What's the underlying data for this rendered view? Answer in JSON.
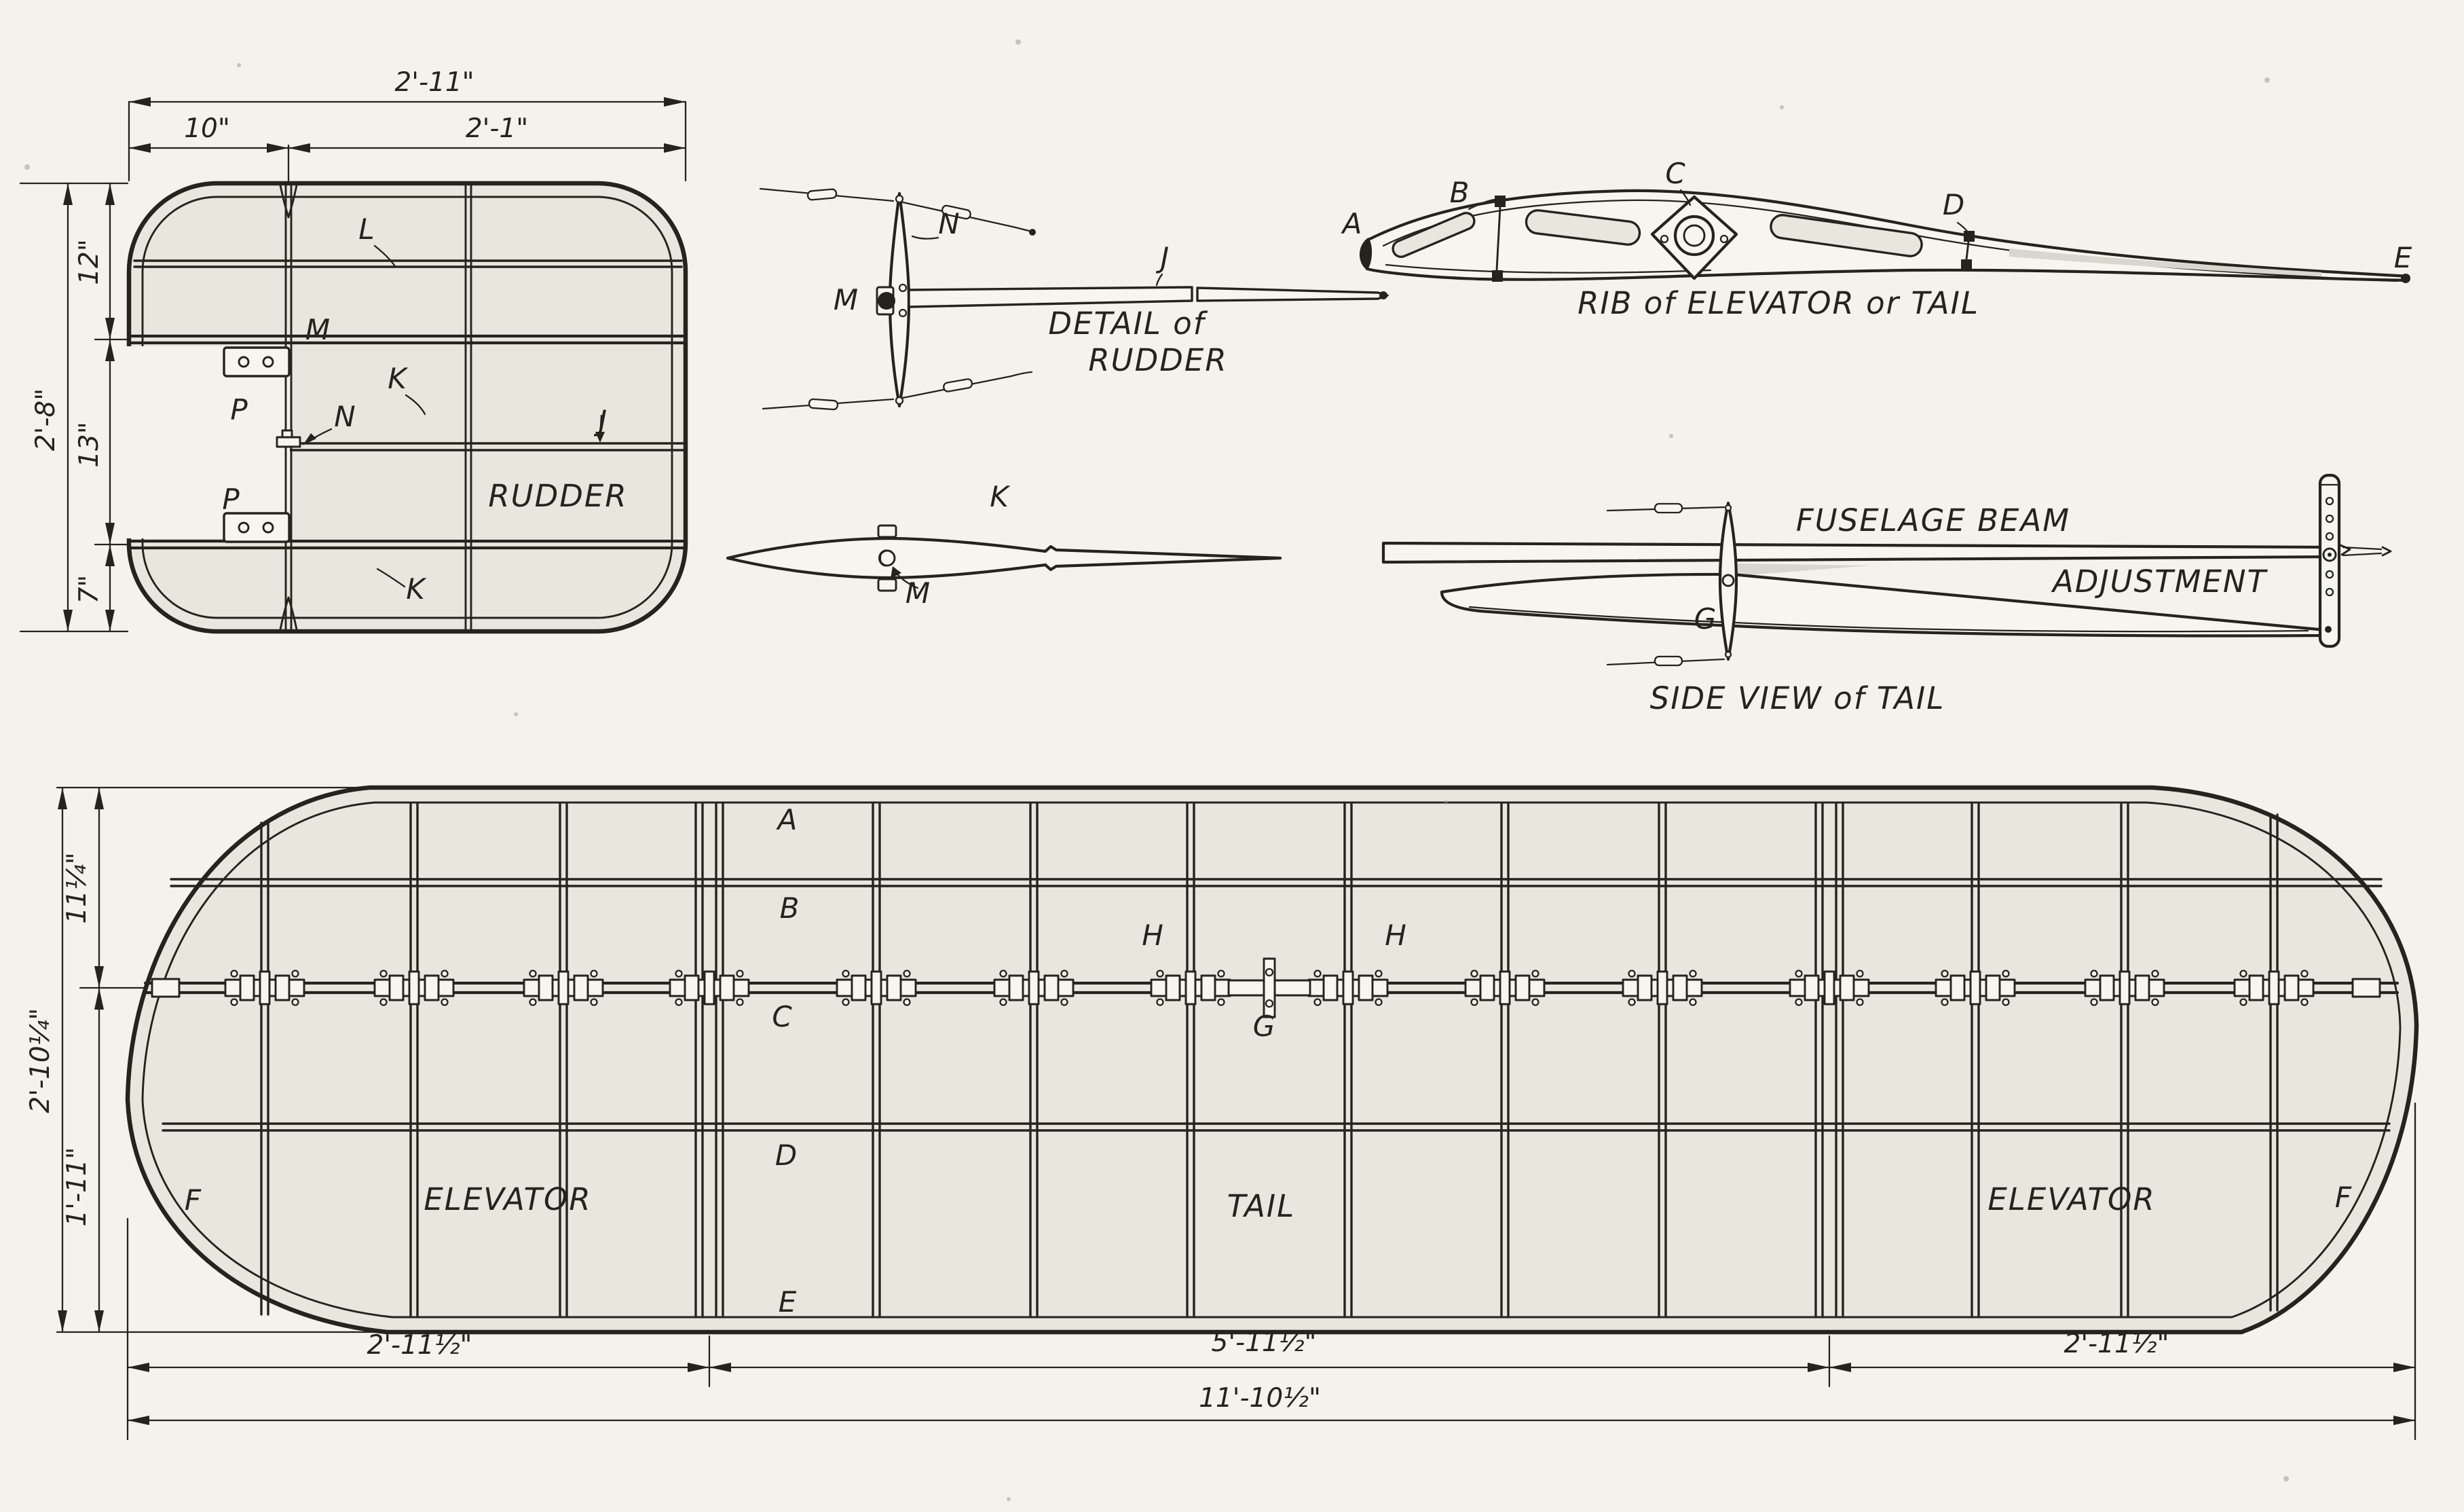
{
  "colors": {
    "ink": "#26231e",
    "paper": "#f4f2ec",
    "panel": "#e9e6de"
  },
  "rudder_plan": {
    "name_label": "RUDDER",
    "dim_top_overall": "2'-11\"",
    "dim_top_left": "10\"",
    "dim_top_right": "2'-1\"",
    "dim_left_overall": "2'-8\"",
    "dim_left_top": "12\"",
    "dim_left_mid": "13\"",
    "dim_left_bottom": "7\"",
    "label_L": "L",
    "label_M": "M",
    "label_K_upper": "K",
    "label_K_lower": "K",
    "label_P_upper": "P",
    "label_P_lower": "P",
    "label_N": "N",
    "label_J": "J"
  },
  "rudder_detail": {
    "title_line1": "DETAIL of",
    "title_line2": "RUDDER",
    "label_N": "N",
    "label_M": "M",
    "label_J": "J"
  },
  "spar_view": {
    "label_K": "K",
    "label_M": "M"
  },
  "rib_detail": {
    "title": "RIB of ELEVATOR or TAIL",
    "label_A": "A",
    "label_B": "B",
    "label_C": "C",
    "label_D": "D",
    "label_E": "E"
  },
  "side_view": {
    "title": "SIDE VIEW of TAIL",
    "fuselage_beam": "FUSELAGE BEAM",
    "adjustment": "ADJUSTMENT",
    "label_G": "G"
  },
  "tail_plan": {
    "label_A": "A",
    "label_B": "B",
    "label_C": "C",
    "label_D": "D",
    "label_E": "E",
    "label_F": "F",
    "label_H": "H",
    "label_G": "G",
    "elevator_left": "ELEVATOR",
    "tail_center": "TAIL",
    "elevator_right": "ELEVATOR",
    "dim_height_top": "11¼\"",
    "dim_height_overall": "2'-10¼\"",
    "dim_height_bottom": "1'-11\"",
    "dim_bottom_left": "2'-11½\"",
    "dim_bottom_mid": "5'-11½\"",
    "dim_bottom_right": "2'-11½\"",
    "dim_bottom_overall": "11'-10½\""
  }
}
